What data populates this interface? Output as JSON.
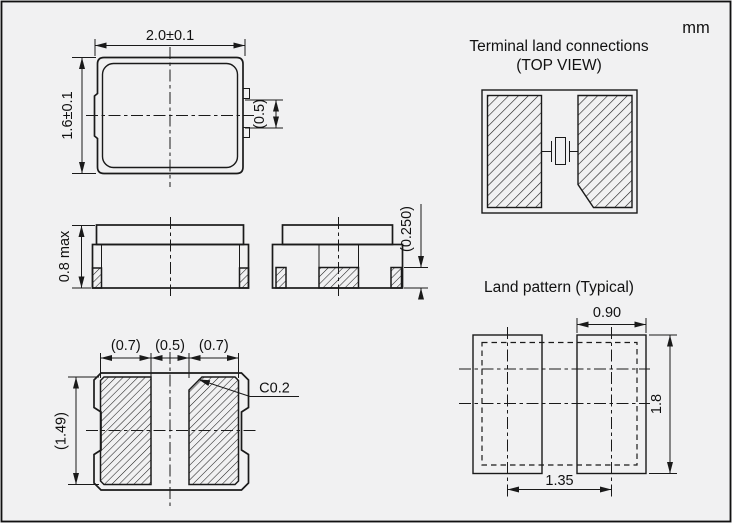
{
  "unit": "mm",
  "package_top_view": {
    "width": "2.0±0.1",
    "height": "1.6±0.1",
    "side_terminal_width": "(0.5)"
  },
  "package_front_view": {
    "max_height": "0.8 max"
  },
  "package_end_view": {
    "terminal_thickness": "(0.250)"
  },
  "package_bottom_view": {
    "left_pad_width": "(0.7)",
    "pad_gap": "(0.5)",
    "right_pad_width": "(0.7)",
    "pad_length": "(1.49)",
    "corner_chamfer": "C0.2"
  },
  "terminal_land_connections": {
    "title": "Terminal land connections",
    "subtitle": "(TOP VIEW)"
  },
  "land_pattern": {
    "title": "Land pattern (Typical)",
    "pad_width": "0.90",
    "pad_height": "1.8",
    "pad_pitch": "1.35"
  },
  "colors": {
    "line": "#1a1a1a",
    "background": "#f1f1f2"
  }
}
